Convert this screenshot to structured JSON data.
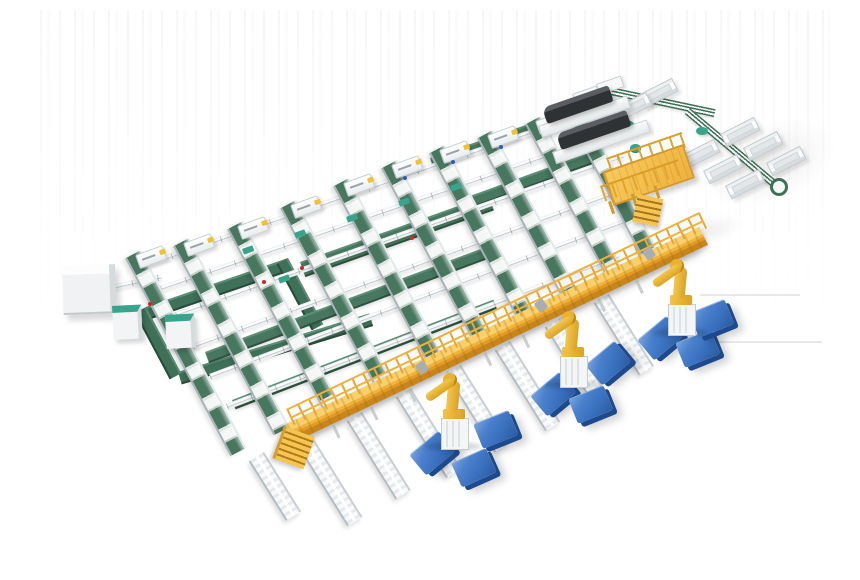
{
  "scene": {
    "title": "Automated sortation and robotic palletizing line - isometric 3D render",
    "background": "#ffffff",
    "view": "isometric",
    "has_text": false
  },
  "colors": {
    "belt-green": "#47775f",
    "loop-green": "#3f7058",
    "accent-teal": "#36a58b",
    "walkway-yellow": "#f0b43c",
    "walkway-shadow": "#c8851c",
    "robot-yellow": "#f3c344",
    "pallet-blue": "#3b72c0",
    "pallet-blue-dark": "#1d4a8c",
    "machine-dark": "#2f3235",
    "marker-red": "#cc2a1e",
    "marker-blue": "#2a5fb0"
  },
  "objects": {
    "sorter_lanes": 10,
    "lane_infeed_hoods": 10,
    "cross_roller_lines": 6,
    "wide_green_cross_belts": 5,
    "recirculation_loop_segments": 4,
    "labeling_machines": 2,
    "operator_platform": 1,
    "elevated_walkway": 1,
    "walkway_stairs": 1,
    "robot_arms": 3,
    "blue_pallets": 9,
    "discharge_troughs": 8,
    "outfeed_spur_conveyors": 8,
    "control_cabinets": 2,
    "electrical_enclosure": 1,
    "side_tables": 3
  }
}
